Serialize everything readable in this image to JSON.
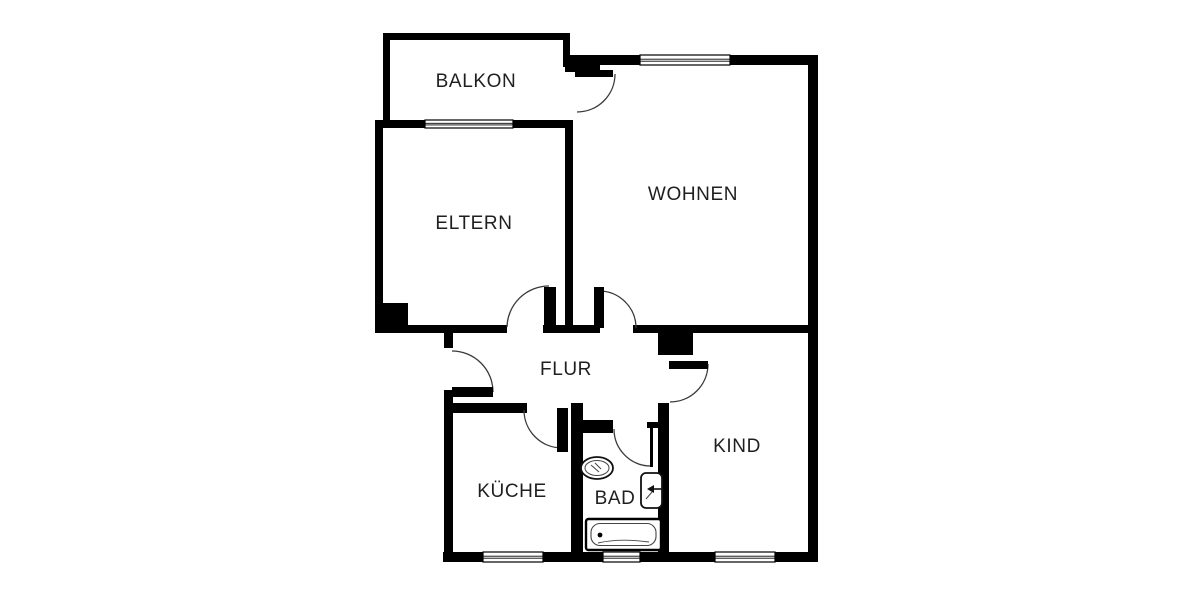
{
  "floorplan": {
    "canvas": {
      "width": 1200,
      "height": 600
    },
    "colors": {
      "background": "#ffffff",
      "wall": "#000000",
      "door_arc": "#3a3a3a",
      "fixture_stroke": "#111111",
      "fixture_inner": "#444444",
      "text": "#1f1f1f"
    },
    "rooms": [
      {
        "id": "balkon",
        "label": "BALKON",
        "cx": 476,
        "cy": 82
      },
      {
        "id": "eltern",
        "label": "ELTERN",
        "cx": 474,
        "cy": 224
      },
      {
        "id": "wohnen",
        "label": "WOHNEN",
        "cx": 693,
        "cy": 195
      },
      {
        "id": "flur",
        "label": "FLUR",
        "cx": 566,
        "cy": 370
      },
      {
        "id": "kueche",
        "label": "KÜCHE",
        "cx": 512,
        "cy": 492
      },
      {
        "id": "bad",
        "label": "BAD",
        "cx": 615,
        "cy": 499
      },
      {
        "id": "kind",
        "label": "KIND",
        "cx": 737,
        "cy": 447
      }
    ],
    "walls": [
      {
        "x": 383,
        "y": 33,
        "w": 7,
        "h": 90
      },
      {
        "x": 383,
        "y": 33,
        "w": 187,
        "h": 7
      },
      {
        "x": 563,
        "y": 33,
        "w": 7,
        "h": 34
      },
      {
        "x": 375,
        "y": 120,
        "w": 50,
        "h": 8
      },
      {
        "x": 513,
        "y": 120,
        "w": 60,
        "h": 8
      },
      {
        "x": 375,
        "y": 120,
        "w": 8,
        "h": 213
      },
      {
        "x": 375,
        "y": 303,
        "w": 33,
        "h": 30
      },
      {
        "x": 375,
        "y": 325,
        "w": 132,
        "h": 8
      },
      {
        "x": 543,
        "y": 325,
        "w": 57,
        "h": 8
      },
      {
        "x": 633,
        "y": 325,
        "w": 182,
        "h": 8
      },
      {
        "x": 565,
        "y": 128,
        "w": 8,
        "h": 199
      },
      {
        "x": 565,
        "y": 55,
        "w": 35,
        "h": 17
      },
      {
        "x": 565,
        "y": 55,
        "w": 75,
        "h": 10
      },
      {
        "x": 730,
        "y": 55,
        "w": 88,
        "h": 10
      },
      {
        "x": 808,
        "y": 55,
        "w": 10,
        "h": 507
      },
      {
        "x": 443,
        "y": 552,
        "w": 40,
        "h": 10
      },
      {
        "x": 543,
        "y": 552,
        "w": 60,
        "h": 10
      },
      {
        "x": 640,
        "y": 552,
        "w": 75,
        "h": 10
      },
      {
        "x": 775,
        "y": 552,
        "w": 43,
        "h": 10
      },
      {
        "x": 444,
        "y": 325,
        "w": 9,
        "h": 23
      },
      {
        "x": 444,
        "y": 390,
        "w": 9,
        "h": 162
      },
      {
        "x": 453,
        "y": 403,
        "w": 74,
        "h": 10
      },
      {
        "x": 571,
        "y": 403,
        "w": 12,
        "h": 149
      },
      {
        "x": 583,
        "y": 420,
        "w": 30,
        "h": 13
      },
      {
        "x": 647,
        "y": 422,
        "w": 13,
        "h": 6
      },
      {
        "x": 658,
        "y": 403,
        "w": 11,
        "h": 149
      },
      {
        "x": 658,
        "y": 333,
        "w": 35,
        "h": 22
      }
    ],
    "windows": [
      {
        "x": 425,
        "y": 120,
        "w": 88,
        "h": 8
      },
      {
        "x": 640,
        "y": 55,
        "w": 90,
        "h": 10
      },
      {
        "x": 483,
        "y": 552,
        "w": 60,
        "h": 10
      },
      {
        "x": 603,
        "y": 552,
        "w": 37,
        "h": 10
      },
      {
        "x": 715,
        "y": 552,
        "w": 60,
        "h": 10
      }
    ],
    "door_leaves": [
      {
        "x": 575,
        "y": 70,
        "w": 38,
        "h": 7
      },
      {
        "x": 544,
        "y": 287,
        "w": 12,
        "h": 41
      },
      {
        "x": 594,
        "y": 287,
        "w": 10,
        "h": 41
      },
      {
        "x": 452,
        "y": 387,
        "w": 41,
        "h": 10
      },
      {
        "x": 557,
        "y": 408,
        "w": 11,
        "h": 44
      },
      {
        "x": 669,
        "y": 361,
        "w": 39,
        "h": 8
      },
      {
        "x": 650,
        "y": 428,
        "w": 3,
        "h": 39
      }
    ],
    "door_arcs": [
      {
        "d": "M615,74 A38,38 0 0 1 577,112"
      },
      {
        "d": "M507,327 A42,42 0 0 1 549,286"
      },
      {
        "d": "M599,291 A37,37 0 0 1 636,328"
      },
      {
        "d": "M452,351 A41,41 0 0 1 493,392"
      },
      {
        "d": "M524,410 A38,38 0 0 0 562,448"
      },
      {
        "d": "M708,364 A38,38 0 0 1 670,402"
      },
      {
        "d": "M614,429 A37,37 0 0 0 651,466"
      }
    ],
    "fixtures": {
      "sink": {
        "cx": 597,
        "cy": 468,
        "rx": 16,
        "ry": 11
      },
      "toilet": {
        "x": 641,
        "y": 473,
        "w": 21,
        "h": 35,
        "arrow_y": 489
      },
      "bathtub": {
        "x": 586,
        "y": 519,
        "w": 75,
        "h": 31,
        "drain_x": 600,
        "drain_y": 535
      }
    }
  }
}
